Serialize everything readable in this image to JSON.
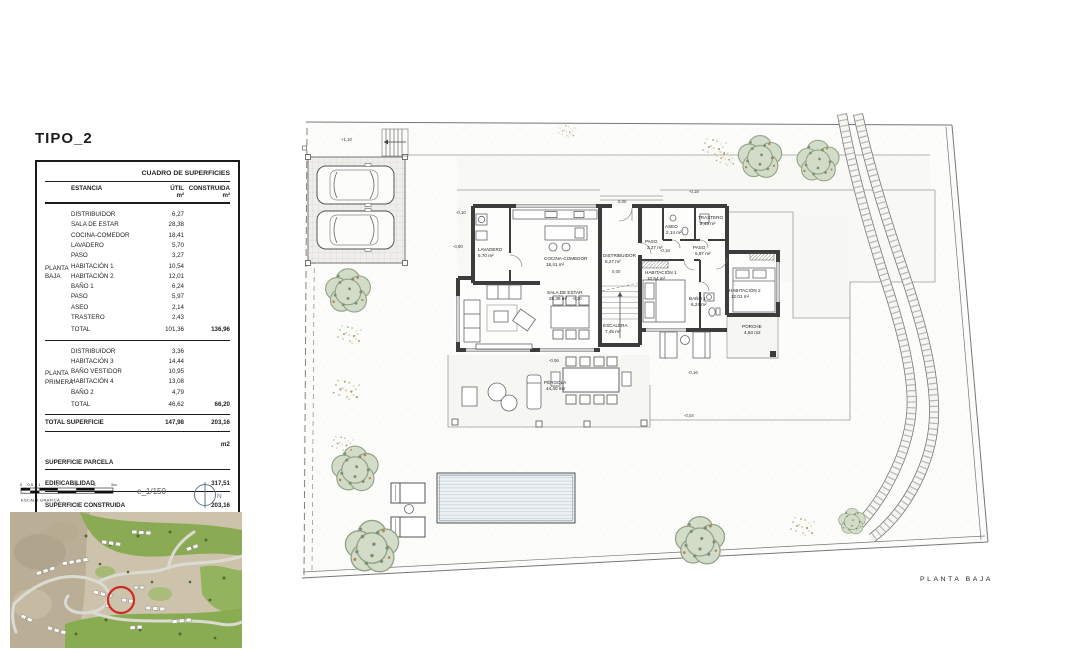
{
  "page": {
    "title": "TIPO_2"
  },
  "table": {
    "title": "CUADRO DE SUPERFICIES",
    "columns": {
      "estancia": "ESTANCIA",
      "util": "ÚTIL",
      "construida": "CONSTRUIDA",
      "unit": "m²"
    },
    "groups": [
      {
        "label": [
          "PLANTA",
          "BAJA"
        ],
        "rows": [
          {
            "name": "DISTRIBUIDOR",
            "util": "6,27"
          },
          {
            "name": "SALA DE ESTAR",
            "util": "28,38"
          },
          {
            "name": "COCINA-COMEDOR",
            "util": "18,41"
          },
          {
            "name": "LAVADERO",
            "util": "5,70"
          },
          {
            "name": "PASO",
            "util": "3,27"
          },
          {
            "name": "HABITACIÓN 1",
            "util": "10,54"
          },
          {
            "name": "HABITACIÓN 2",
            "util": "12,01"
          },
          {
            "name": "BAÑO 1",
            "util": "6,24"
          },
          {
            "name": "PASO",
            "util": "5,97"
          },
          {
            "name": "ASEO",
            "util": "2,14"
          },
          {
            "name": "TRASTERO",
            "util": "2,43"
          }
        ],
        "total": {
          "name": "TOTAL",
          "util": "101,36",
          "construida": "136,96"
        }
      },
      {
        "label": [
          "PLANTA",
          "PRIMERA"
        ],
        "rows": [
          {
            "name": "DISTRIBUIDOR",
            "util": "3,36"
          },
          {
            "name": "HABITACIÓN 3",
            "util": "14,44"
          },
          {
            "name": "BAÑO VESTIDOR",
            "util": "10,95"
          },
          {
            "name": "HABITACIÓN 4",
            "util": "13,08"
          },
          {
            "name": "BAÑO 2",
            "util": "4,79"
          }
        ],
        "total": {
          "name": "TOTAL",
          "util": "46,62",
          "construida": "66,20"
        }
      }
    ],
    "summary": {
      "total_superficie": {
        "label": "TOTAL SUPERFICIE",
        "util": "147,98",
        "construida": "203,16"
      },
      "unit_label": "m2",
      "rows": [
        {
          "label": "SUPERFICIE PARCELA",
          "value": ""
        },
        {
          "label": "EDIFICABILIDAD",
          "value": "317,51"
        },
        {
          "label": "SUPERFICIE CONSTRUIDA",
          "value": "203,16"
        }
      ]
    }
  },
  "scale": {
    "ticks": [
      "0",
      "0,5",
      "1",
      "2",
      "3",
      "4",
      "5m"
    ],
    "caption": "ESCALA GRAFICA",
    "ratio": "e_1/150",
    "north": "N"
  },
  "plan": {
    "label": "PLANTA BAJA",
    "rooms": [
      {
        "name": "LAVADERO",
        "area": "5,70  m²"
      },
      {
        "name": "COCINA-COMEDOR",
        "area": "18,41 m²"
      },
      {
        "name": "DISTRIBUIDOR",
        "area": "6,27 m²"
      },
      {
        "name": "SALA DE ESTAR",
        "area": "28,38 m²"
      },
      {
        "name": "ESCALERA",
        "area": "7,45 m²"
      },
      {
        "name": "PASO",
        "area": "3,27 m²"
      },
      {
        "name": "ASEO",
        "area": "2,14 m²"
      },
      {
        "name": "TRASTERO",
        "area": "2,43 m²"
      },
      {
        "name": "PASO",
        "area": "5,97 m²"
      },
      {
        "name": "HABITACIÓN 1",
        "area": "10,54 m²"
      },
      {
        "name": "BAÑO 1",
        "area": "6,24 m²"
      },
      {
        "name": "HABITACIÓN 2",
        "area": "12,01 m²"
      },
      {
        "name": "PORCHE",
        "area": "4,63 m2"
      },
      {
        "name": "PÉRGOLA",
        "area": "44,40 m2"
      }
    ],
    "levels": [
      "+1,10",
      "0,00",
      "-0,18",
      "-0,10",
      "-0,90",
      "0,00",
      "-0,18",
      "-0,30",
      "-0,06",
      "-0,16",
      "-0,04"
    ]
  },
  "colors": {
    "marker_red": "#cf2b24",
    "wall": "#3c3c3c"
  }
}
